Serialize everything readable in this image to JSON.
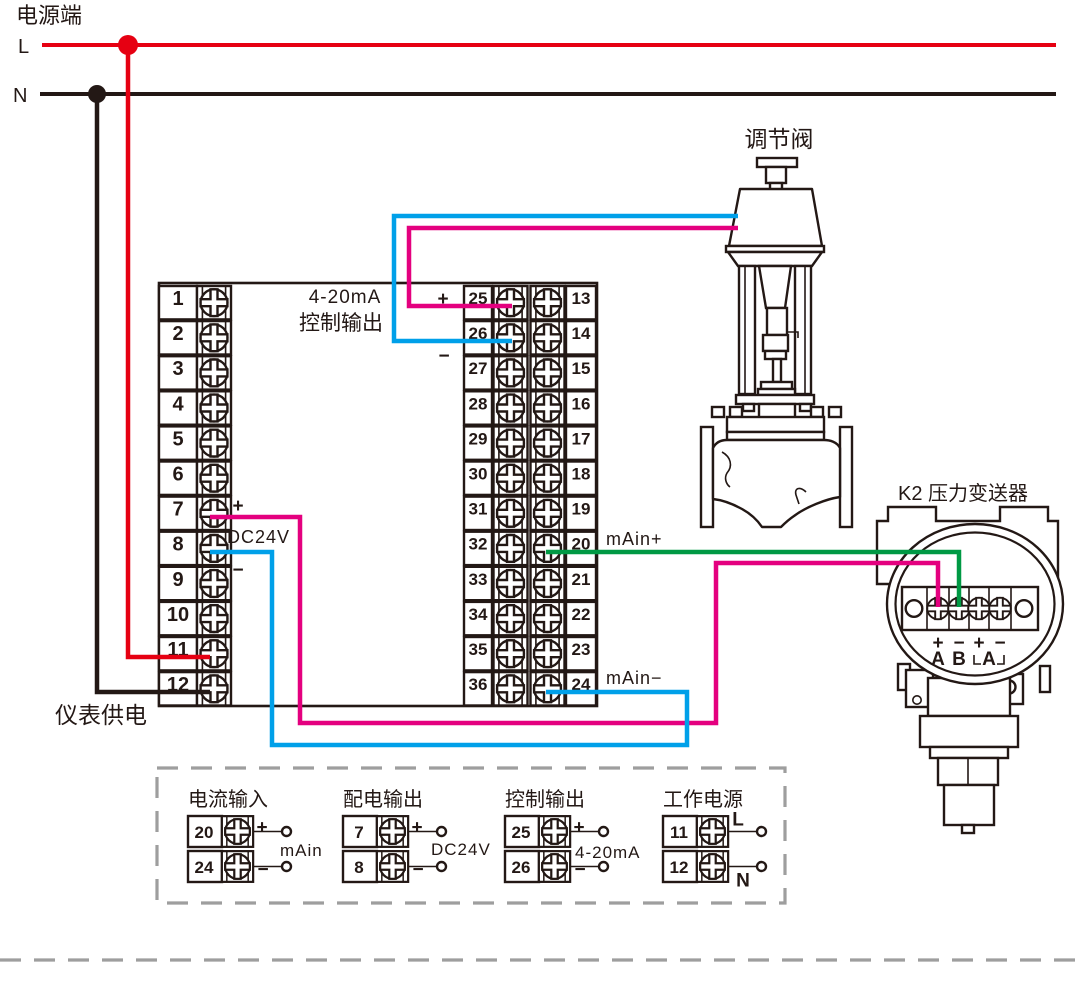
{
  "power": {
    "title": "电源端",
    "l_label": "L",
    "n_label": "N"
  },
  "instrument": {
    "supply_label": "仪表供电",
    "left_terminals": [
      "1",
      "2",
      "3",
      "4",
      "5",
      "6",
      "7",
      "8",
      "9",
      "10",
      "11",
      "12"
    ],
    "right_terminals_inner": [
      "25",
      "26",
      "27",
      "28",
      "29",
      "30",
      "31",
      "32",
      "33",
      "34",
      "35",
      "36"
    ],
    "right_terminals_outer": [
      "13",
      "14",
      "15",
      "16",
      "17",
      "18",
      "19",
      "20",
      "21",
      "22",
      "23",
      "24"
    ],
    "control_output_line1": "4-20mA",
    "control_output_line2": "控制输出",
    "t25_sign": "+",
    "t26_sign": "−",
    "t7_sign": "+",
    "dc24v_label": "DC24V",
    "t8_sign": "−",
    "main_plus_label": "mAin+",
    "main_minus_label": "mAin−"
  },
  "valve": {
    "label": "调节阀"
  },
  "transmitter": {
    "label": "K2  压力变送器",
    "signs": [
      "+",
      "−",
      "+",
      "−"
    ],
    "letters": [
      "A",
      "B",
      "A"
    ]
  },
  "legend": {
    "groups": [
      {
        "title": "电流输入",
        "rows": [
          {
            "num": "20",
            "sign": "+"
          },
          {
            "num": "24",
            "sign": "−"
          }
        ],
        "label": "mAin"
      },
      {
        "title": "配电输出",
        "rows": [
          {
            "num": "7",
            "sign": "+"
          },
          {
            "num": "8",
            "sign": "−"
          }
        ],
        "label": "DC24V"
      },
      {
        "title": "控制输出",
        "rows": [
          {
            "num": "25",
            "sign": "+"
          },
          {
            "num": "26",
            "sign": "−"
          }
        ],
        "label": "4-20mA"
      },
      {
        "title": "工作电源",
        "rows": [
          {
            "num": "11",
            "sign": "L"
          },
          {
            "num": "12",
            "sign": "N"
          }
        ],
        "label": ""
      }
    ]
  },
  "colors": {
    "line": "#231815",
    "live": "#e60012",
    "neutral": "#231815",
    "control_pos": "#e4007f",
    "control_neg": "#00a0e9",
    "signal_pos": "#009944",
    "signal_neg": "#00a0e9",
    "dashed": "#9e9e9e"
  }
}
